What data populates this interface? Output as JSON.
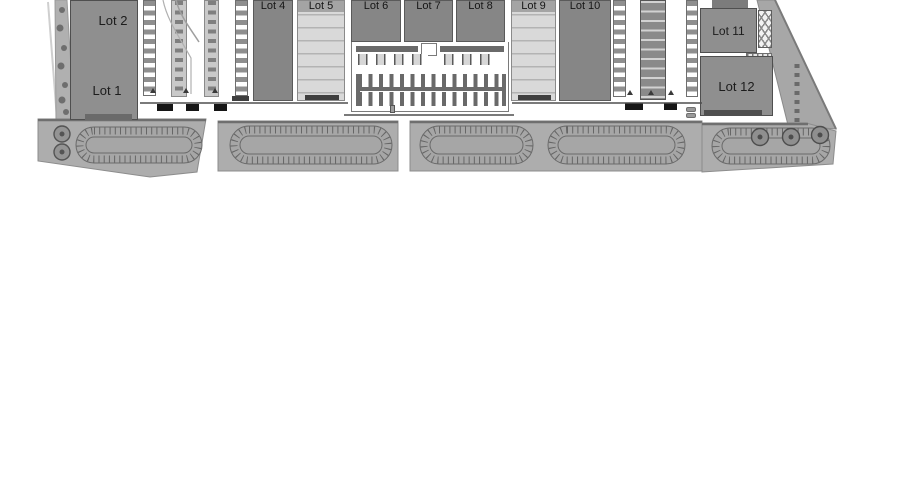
{
  "palette": {
    "building_gray": "#8f8f8f",
    "lot_dark_gray": "#868686",
    "yard_light_gray": "#d9d9d9",
    "parking_band_gray": "#adadad",
    "island_gray": "#a6a6a6",
    "line_dark": "#4f4f4f",
    "mark_black": "#161616",
    "background": "#ffffff"
  },
  "lots": [
    {
      "label": "Lot 1"
    },
    {
      "label": "Lot 2"
    },
    {
      "label": "Lot 4"
    },
    {
      "label": "Lot 5"
    },
    {
      "label": "Lot 6"
    },
    {
      "label": "Lot 7"
    },
    {
      "label": "Lot 8"
    },
    {
      "label": "Lot 9"
    },
    {
      "label": "Lot 10"
    },
    {
      "label": "Lot 11"
    },
    {
      "label": "Lot 12"
    }
  ]
}
